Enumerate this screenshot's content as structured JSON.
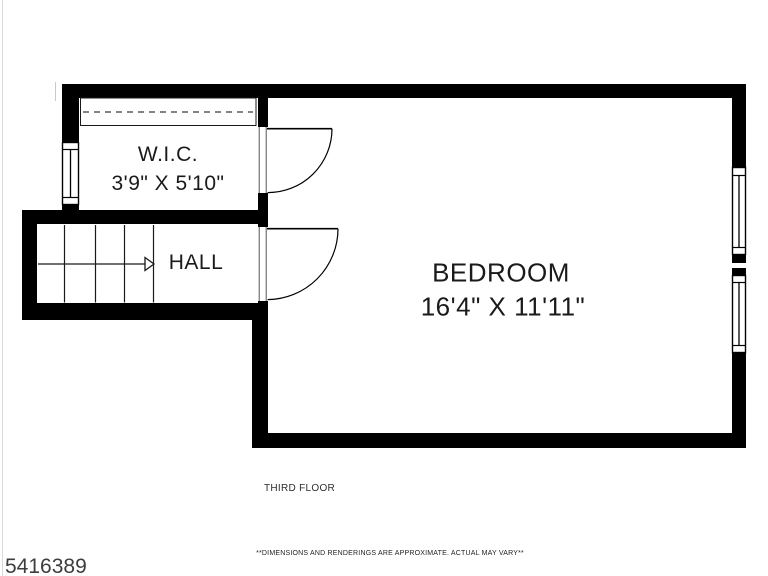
{
  "rooms": {
    "wic": {
      "label": "W.I.C.",
      "dims": "3'9\" X 5'10\""
    },
    "hall": {
      "label": "HALL"
    },
    "bedroom": {
      "label": "BEDROOM",
      "dims": "16'4\" X 11'11\""
    }
  },
  "footer": {
    "floor_label": "THIRD FLOOR",
    "disclaimer": "**DIMENSIONS AND RENDERINGS ARE APPROXIMATE. ACTUAL MAY VARY**",
    "listing_id": "5416389"
  },
  "colors": {
    "wall": "#000000",
    "background": "#ffffff",
    "line": "#1a1a1a"
  }
}
